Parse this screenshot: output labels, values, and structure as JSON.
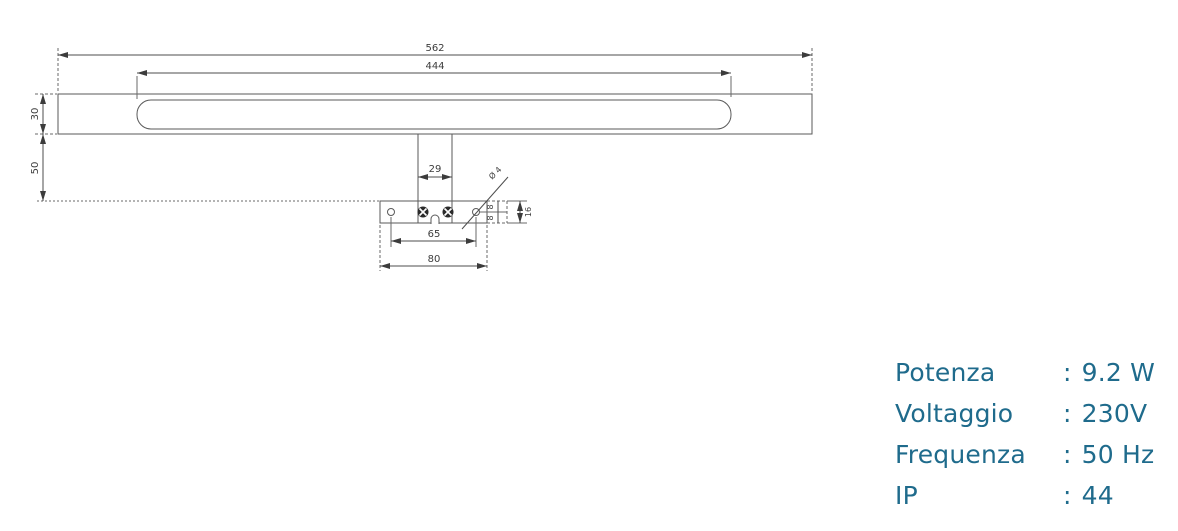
{
  "drawing": {
    "dimensions": {
      "overall_width": "562",
      "lamp_body_width": "444",
      "lamp_body_height": "30",
      "arm_drop": "50",
      "arm_width": "29",
      "hole_spacing": "65",
      "plate_width": "80",
      "plate_height": "16",
      "hole_offset_top": "8",
      "hole_offset_bottom": "8",
      "hole_diameter": "Ø 4"
    }
  },
  "specs": {
    "rows": [
      {
        "label": "Potenza",
        "sep": ":",
        "value": "9.2 W"
      },
      {
        "label": "Voltaggio",
        "sep": ":",
        "value": "230V"
      },
      {
        "label": "Frequenza",
        "sep": ":",
        "value": "50 Hz"
      },
      {
        "label": "IP",
        "sep": ":",
        "value": "44"
      }
    ]
  },
  "colors": {
    "spec_text": "#1f6b8c",
    "drawing_line": "#5a5a5a",
    "dim_text": "#3c3c3c"
  }
}
